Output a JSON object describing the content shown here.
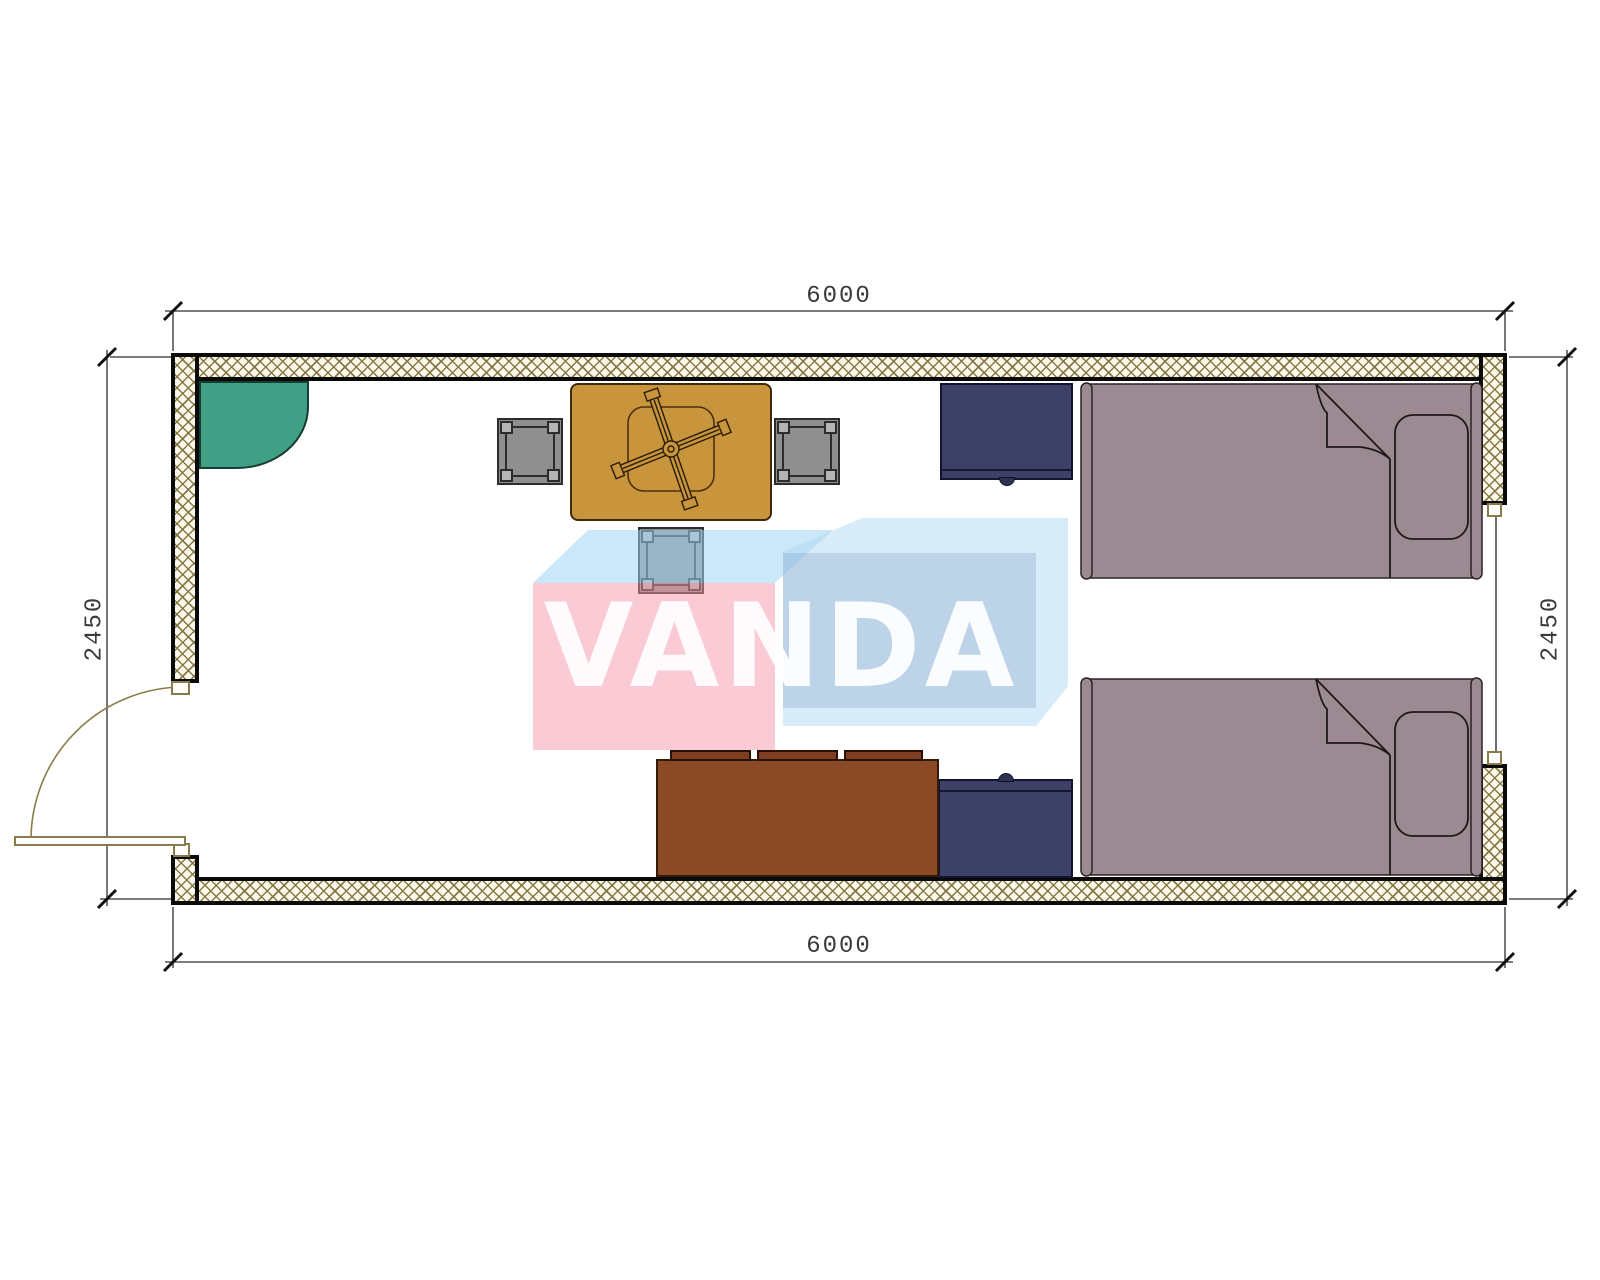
{
  "drawing": {
    "type": "floor-plan",
    "brand_watermark": "VANDA",
    "dimensions": {
      "top": "6000",
      "bottom": "6000",
      "left": "2450",
      "right": "2450"
    },
    "colors": {
      "wall_hatch": "#82733e",
      "wall_edge": "#0a0a0a",
      "bed": "#9c8a92",
      "nightstand": "#3d4168",
      "desk": "#8a4a26",
      "desk_shelf": "#7d3f1f",
      "table": "#c8943c",
      "chair": "#8f8f8f",
      "corner_unit": "#3fa086",
      "door_arc": "#8a7c4a",
      "logo_pink": "#f8cbd7",
      "logo_light_blue": "#d7eafa",
      "logo_blue_front": "#c3d5ea"
    },
    "furniture": [
      "corner-unit",
      "square-table",
      "chair-left",
      "chair-right",
      "chair-bottom",
      "nightstand-top",
      "nightstand-bottom",
      "bed-top",
      "bed-bottom",
      "desk-with-shelves"
    ]
  }
}
